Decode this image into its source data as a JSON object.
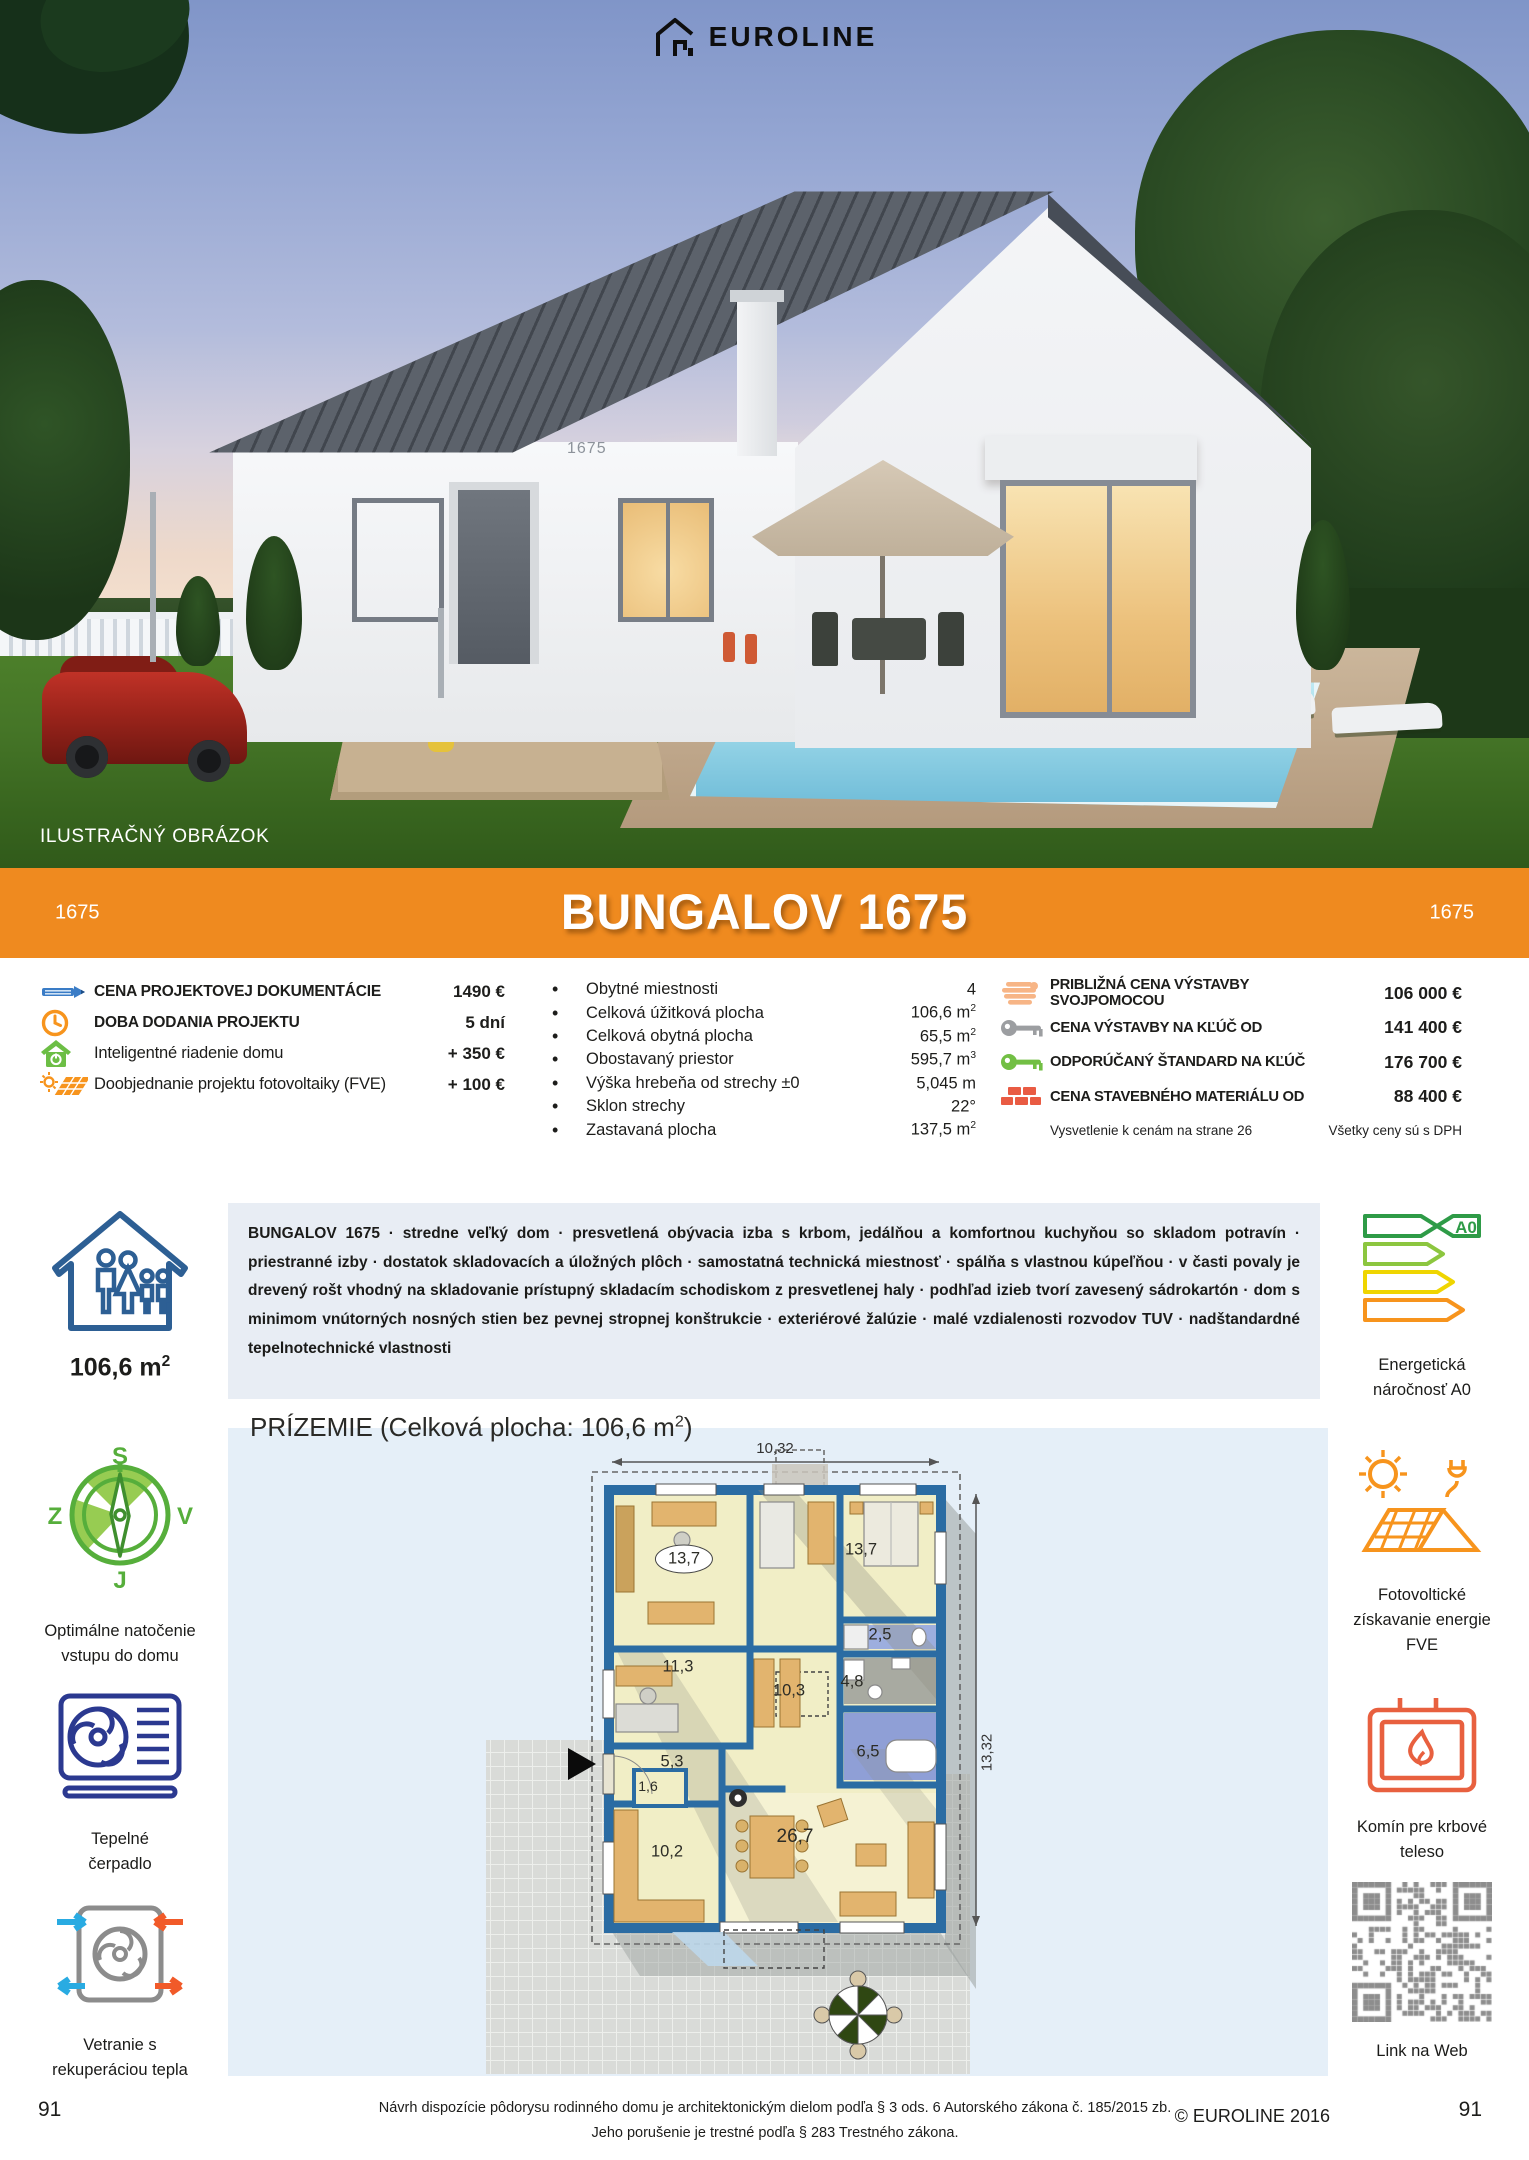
{
  "brand": {
    "name": "EUROLINE"
  },
  "photo": {
    "illustration_label": "ILUSTRAČNÝ OBRÁZOK",
    "house_number": "1675"
  },
  "banner": {
    "title": "BUNGALOV 1675",
    "code_left": "1675",
    "code_right": "1675",
    "accent_color": "#EF8A1F"
  },
  "pricing": {
    "items": [
      {
        "icon": "pencil-icon",
        "label": "CENA PROJEKTOVEJ DOKUMENTÁCIE",
        "value": "1490 €"
      },
      {
        "icon": "clock-icon",
        "label": "DOBA DODANIA PROJEKTU",
        "value": "5 dní"
      },
      {
        "icon": "smart-home-icon",
        "label": "Inteligentné riadenie domu",
        "value": "+ 350 €"
      },
      {
        "icon": "photovoltaics-icon",
        "label": "Doobjednanie projektu fotovoltaiky (FVE)",
        "value": "+ 100 €"
      }
    ]
  },
  "specs": {
    "items": [
      {
        "label": "Obytné miestnosti",
        "value": "4",
        "sup": ""
      },
      {
        "label": "Celková úžitková plocha",
        "value": "106,6 m",
        "sup": "2"
      },
      {
        "label": "Celková obytná plocha",
        "value": "65,5 m",
        "sup": "2"
      },
      {
        "label": "Obostavaný priestor",
        "value": "595,7 m",
        "sup": "3"
      },
      {
        "label": "Výška hrebeňa od strechy ±0",
        "value": "5,045 m",
        "sup": ""
      },
      {
        "label": "Sklon strechy",
        "value": "22°",
        "sup": ""
      },
      {
        "label": "Zastavaná plocha",
        "value": "137,5 m",
        "sup": "2"
      }
    ]
  },
  "construction": {
    "items": [
      {
        "icon": "hand-icon",
        "label": "PRIBLIŽNÁ CENA VÝSTAVBY SVOJPOMOCOU",
        "value": "106 000 €"
      },
      {
        "icon": "key-gray-icon",
        "label": "CENA VÝSTAVBY NA KĽÚČ OD",
        "value": "141 400 €"
      },
      {
        "icon": "key-green-icon",
        "label": "ODPORÚČANÝ ŠTANDARD NA KĽÚČ",
        "value": "176 700 €"
      },
      {
        "icon": "bricks-icon",
        "label": "CENA STAVEBNÉHO MATERIÁLU OD",
        "value": "88 400 €"
      }
    ],
    "note_left": "Vysvetlenie k cenám na strane 26",
    "note_right": "Všetky ceny sú s DPH"
  },
  "description": {
    "text": "BUNGALOV 1675 · stredne veľký dom · presvetlená obývacia izba s krbom, jedálňou a komfortnou kuchyňou so skladom potravín · priestranné izby · dostatok skladovacích a úložných plôch · samostatná technická miestnosť · spálňa s vlastnou kúpeľňou · v časti povaly je drevený rošt vhodný na skladovanie prístupný skladacím schodiskom z presvetlenej haly · podhľad izieb tvorí zavesený sádrokartón · dom s minimom vnútorných nosných stien bez pevnej stropnej konštrukcie · exteriérové žalúzie · malé vzdialenosti rozvodov TUV · nadštandardné tepelnotechnické vlastnosti"
  },
  "left_sidebar": {
    "area_value": "106,6 m",
    "area_sup": "2",
    "compass": {
      "n": "S",
      "e": "V",
      "s": "J",
      "w": "Z"
    },
    "compass_label_1": "Optimálne natočenie",
    "compass_label_2": "vstupu do domu",
    "heatpump_label_1": "Tepelné",
    "heatpump_label_2": "čerpadlo",
    "ventilation_label_1": "Vetranie s",
    "ventilation_label_2": "rekuperáciou tepla",
    "page_number": "91"
  },
  "right_sidebar": {
    "energy_rating": "A0",
    "energy_label_1": "Energetická",
    "energy_label_2": "náročnosť A0",
    "fve_label_1": "Fotovoltické",
    "fve_label_2": "získavanie energie",
    "fve_label_3": "FVE",
    "chimney_label_1": "Komín pre krbové",
    "chimney_label_2": "teleso",
    "qr_label": "Link na Web",
    "page_number": "91"
  },
  "floorplan": {
    "heading_prefix": "PRÍZEMIE (Celková plocha: 106,6 m",
    "heading_sup": "2",
    "heading_suffix": ")",
    "dim_width": "10,32",
    "dim_height": "13,32",
    "rooms": [
      {
        "area": "13,7"
      },
      {
        "area": "13,7"
      },
      {
        "area": "2,5"
      },
      {
        "area": "11,3"
      },
      {
        "area": "10,3"
      },
      {
        "area": "4,8"
      },
      {
        "area": "6,5"
      },
      {
        "area": "5,3"
      },
      {
        "area": "1,6"
      },
      {
        "area": "10,2"
      },
      {
        "area": "26,7"
      }
    ]
  },
  "footer": {
    "legal_line1": "Návrh dispozície pôdorysu rodinného domu je architektonickým dielom podľa § 3 ods. 6 Autorského zákona č. 185/2015 zb.",
    "legal_line2": "Jeho porušenie je trestné podľa § 283 Trestného zákona.",
    "copyright": "© EUROLINE 2016"
  }
}
